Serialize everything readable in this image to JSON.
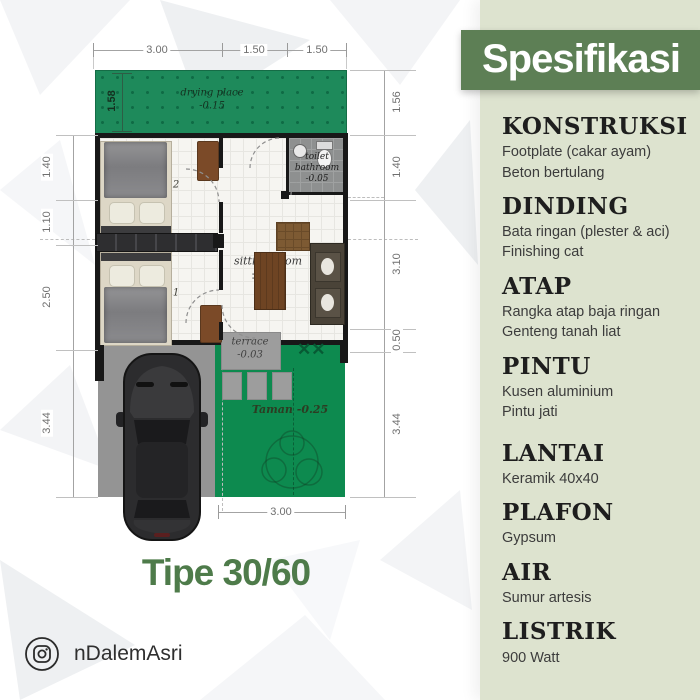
{
  "colors": {
    "banner_green": "#5d7f55",
    "panel_bg": "#dde3cf",
    "drying_green": "#1e8a5b",
    "garden_green": "#0d8a4f",
    "title_green": "#4e7b4a",
    "carport_gray": "#949494",
    "wall_black": "#181818"
  },
  "plan": {
    "title": "Tipe 30/60",
    "instagram_handle": "nDalemAsri",
    "rooms": {
      "drying_place": {
        "name": "drying place",
        "level": "-0.15"
      },
      "bedroom2": {
        "name": "bedroom 2",
        "level": "±0.00"
      },
      "bedroom1": {
        "name": "bedroom 1",
        "level": "±0.00"
      },
      "toilet": {
        "name": "toilet bathroom",
        "level": "-0.05"
      },
      "sitting_room": {
        "name": "sitting room",
        "level": "±0.00"
      },
      "terrace": {
        "name": "terrace",
        "level": "-0.03"
      },
      "garden": {
        "name": "Taman",
        "level": "-0.25"
      }
    },
    "dimensions": {
      "top": [
        "3.00",
        "1.50",
        "1.50"
      ],
      "left": [
        "1.40",
        "1.10",
        "2.50",
        "3.44"
      ],
      "left_inner": "1.58",
      "right": [
        "1.56",
        "1.40",
        "3.10",
        "0.50",
        "3.44"
      ],
      "bottom": "3.00"
    }
  },
  "spec_panel": {
    "header": "Spesifikasi",
    "items": [
      {
        "title": "KONSTRUKSI",
        "lines": [
          "Footplate (cakar ayam)",
          "Beton bertulang"
        ]
      },
      {
        "title": "DINDING",
        "lines": [
          "Bata ringan (plester & aci)",
          "Finishing cat"
        ]
      },
      {
        "title": "ATAP",
        "lines": [
          "Rangka atap baja ringan",
          "Genteng tanah liat"
        ]
      },
      {
        "title": "PINTU",
        "lines": [
          "Kusen aluminium",
          "Pintu jati"
        ]
      },
      {
        "title": "LANTAI",
        "lines": [
          "Keramik 40x40"
        ]
      },
      {
        "title": "PLAFON",
        "lines": [
          "Gypsum"
        ]
      },
      {
        "title": "AIR",
        "lines": [
          "Sumur artesis"
        ]
      },
      {
        "title": "LISTRIK",
        "lines": [
          "900 Watt"
        ]
      }
    ]
  }
}
